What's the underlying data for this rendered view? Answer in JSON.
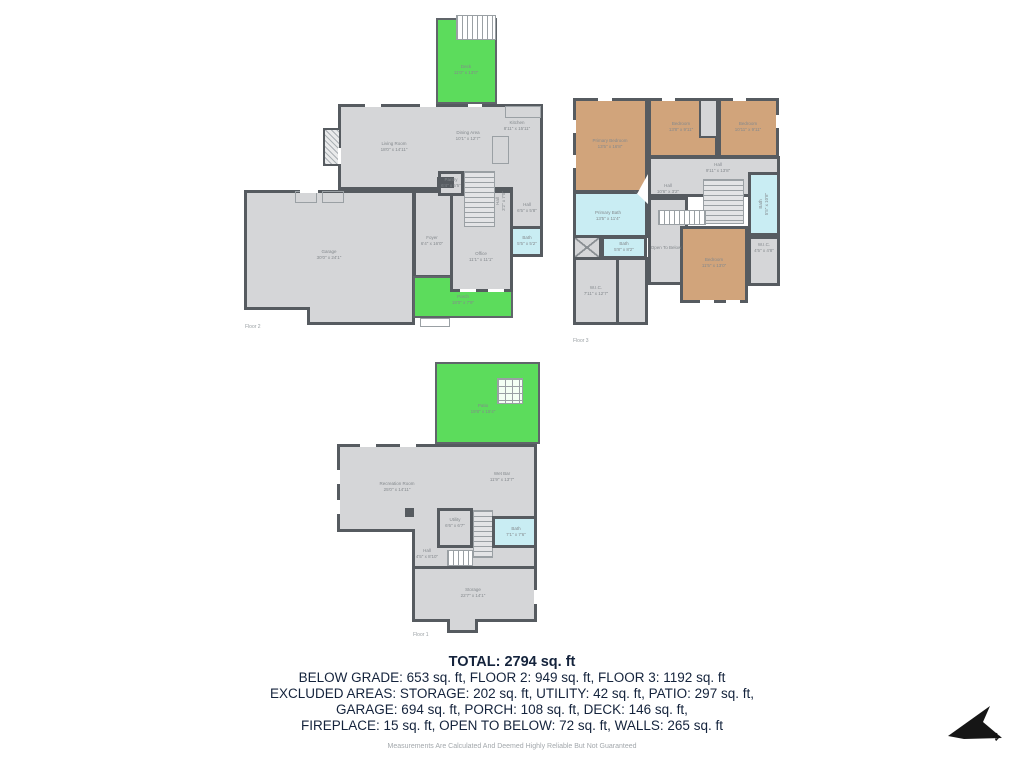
{
  "summary": {
    "total": "TOTAL: 2794 sq. ft",
    "line2": "BELOW GRADE: 653 sq. ft, FLOOR 2: 949 sq. ft, FLOOR 3: 1192 sq. ft",
    "line3": "EXCLUDED AREAS: STORAGE: 202 sq. ft, UTILITY: 42 sq. ft, PATIO: 297 sq. ft,",
    "line4": "GARAGE: 694 sq. ft, PORCH: 108 sq. ft, DECK: 146 sq. ft,",
    "line5": "FIREPLACE: 15 sq. ft, OPEN TO BELOW: 72 sq. ft, WALLS: 265 sq. ft",
    "disclaimer": "Measurements Are Calculated And Deemed Highly Reliable But Not Guaranteed"
  },
  "compass": {
    "label": "N"
  },
  "colors": {
    "wall": "#565b60",
    "floor_gray": "#d5d6d8",
    "outdoor_green": "#5cdc5c",
    "bedroom_tan": "#d1a47b",
    "bath_blue": "#c9edf3",
    "room_label_gray": "#84898d",
    "summary_text": "#14233c"
  },
  "floors": {
    "floor2": {
      "label": "Floor 2",
      "rooms": {
        "deck": {
          "name": "Deck",
          "dims": "11'0\" x 13'0\""
        },
        "living_room": {
          "name": "Living Room",
          "dims": "18'0\" x 14'11\""
        },
        "dining_area": {
          "name": "Dining Area",
          "dims": "10'1\" x 12'7\""
        },
        "kitchen": {
          "name": "Kitchen",
          "dims": "8'11\" x 15'11\""
        },
        "pantry": {
          "name": "Pantry",
          "dims": "6'4\" x 5'5\""
        },
        "hall_stairs": {
          "name": "Hall",
          "dims": "3'2\" x 7'0\""
        },
        "hall": {
          "name": "Hall",
          "dims": "6'5\" x 5'8\""
        },
        "bath": {
          "name": "Bath",
          "dims": "5'5\" x 5'2\""
        },
        "garage": {
          "name": "Garage",
          "dims": "30'0\" x 24'1\""
        },
        "foyer": {
          "name": "Foyer",
          "dims": "6'4\" x 16'0\""
        },
        "office": {
          "name": "Office",
          "dims": "11'1\" x 11'1\""
        },
        "porch": {
          "name": "Porch",
          "dims": "18'0\" x 7'9\""
        }
      }
    },
    "floor3": {
      "label": "Floor 3",
      "rooms": {
        "primary_bedroom": {
          "name": "Primary Bedroom",
          "dims": "13'5\" x 16'8\""
        },
        "bedroom_mid": {
          "name": "Bedroom",
          "dims": "13'8\" x 9'11\""
        },
        "bedroom_right": {
          "name": "Bedroom",
          "dims": "10'11\" x 9'11\""
        },
        "hall_upper": {
          "name": "Hall",
          "dims": "9'11\" x 13'8\""
        },
        "hall_small": {
          "name": "Hall",
          "dims": "10'6\" x 3'2\""
        },
        "bath_right": {
          "name": "Bath",
          "dims": "5'5\" x 10'8\""
        },
        "primary_bath": {
          "name": "Primary Bath",
          "dims": "13'5\" x 11'4\""
        },
        "bath_small": {
          "name": "Bath",
          "dims": "5'8\" x 8'2\""
        },
        "open_below": {
          "name": "Open To Below",
          "dims": ""
        },
        "bedroom_bottom": {
          "name": "Bedroom",
          "dims": "11'5\" x 13'0\""
        },
        "wic": {
          "name": "W.I.C.",
          "dims": "7'11\" x 12'7\""
        },
        "wic_small": {
          "name": "W.I.C.",
          "dims": "4'5\" x 4'8\""
        }
      }
    },
    "floor1": {
      "label": "Floor 1",
      "rooms": {
        "patio": {
          "name": "Patio",
          "dims": "19'8\" x 15'4\""
        },
        "recreation_room": {
          "name": "Recreation Room",
          "dims": "25'0\" x 14'11\""
        },
        "wet_bar": {
          "name": "Wet Bar",
          "dims": "11'9\" x 13'7\""
        },
        "utility": {
          "name": "Utility",
          "dims": "6'6\" x 6'7\""
        },
        "bath": {
          "name": "Bath",
          "dims": "7'1\" x 7'6\""
        },
        "hall": {
          "name": "Hall",
          "dims": "4'5\" x 8'10\""
        },
        "storage": {
          "name": "Storage",
          "dims": "22'7\" x 14'1\""
        }
      }
    }
  }
}
